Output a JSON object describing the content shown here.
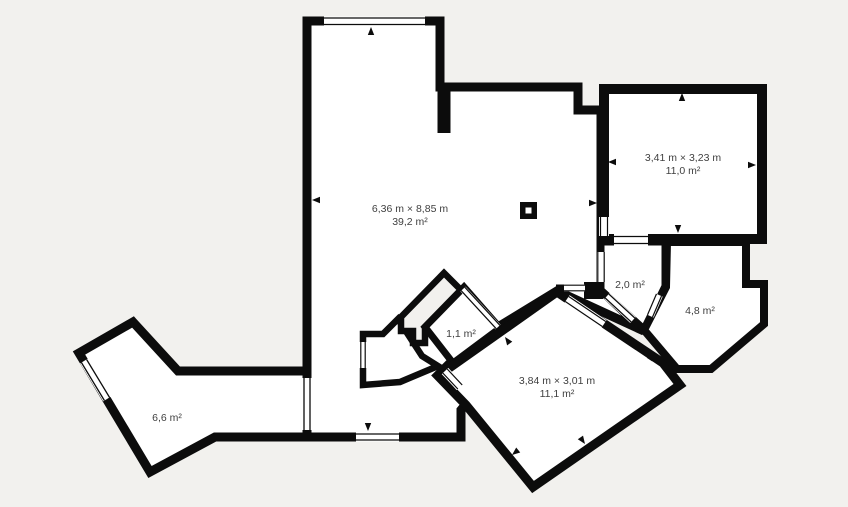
{
  "colors": {
    "background": "#f2f1ee",
    "walls": "#0c0c0c",
    "room_fill": "#ffffff",
    "label_text": "#404040"
  },
  "rooms": [
    {
      "name": "main-room",
      "dimensions": "6,36 m × 8,85 m",
      "area": "39,2 m²"
    },
    {
      "name": "top-right-room",
      "dimensions": "3,41 m × 3,23 m",
      "area": "11,0 m²"
    },
    {
      "name": "center-small-room",
      "dimensions": "",
      "area": "2,0 m²"
    },
    {
      "name": "right-room",
      "dimensions": "",
      "area": "4,8 m²"
    },
    {
      "name": "tiny-rotated-room",
      "dimensions": "",
      "area": "1,1 m²"
    },
    {
      "name": "rotated-room",
      "dimensions": "3,84 m × 3,01 m",
      "area": "11,1 m²"
    },
    {
      "name": "bottom-left-room",
      "dimensions": "",
      "area": "6,6 m²"
    }
  ]
}
